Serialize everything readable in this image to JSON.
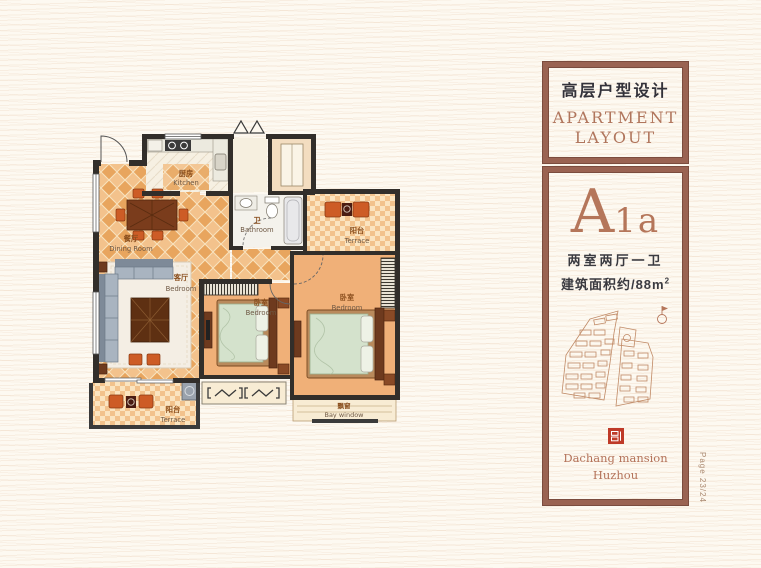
{
  "page": {
    "side_label": "Page 23/24"
  },
  "panel": {
    "title_cn": "高层户型设计",
    "title_en1": "APARTMENT",
    "title_en2": "LAYOUT",
    "unit_letter": "A",
    "unit_number": "1a",
    "spec_rooms": "两室两厅一卫",
    "spec_area": "建筑面积约/88m",
    "spec_area_sup": "2",
    "brand_name": "Dachang mansion",
    "brand_city": "Huzhou",
    "accent_color": "#b5765a",
    "frame_color": "#9a6352",
    "logo_color": "#bf3a28"
  },
  "floorplan": {
    "labels": {
      "kitchen_cn": "厨房",
      "kitchen_en": "Kitchen",
      "dining_cn": "餐厅",
      "dining_en": "Dining Room",
      "bath_cn": "卫",
      "bath_en": "Bathroom",
      "living_cn": "客厅",
      "living_en": "Bedroom",
      "terrace_tr_cn": "阳台",
      "terrace_tr_en": "Terrace",
      "bedroom_m_cn": "卧室",
      "bedroom_m_en": "Bedroom",
      "bedroom_r_cn": "卧室",
      "bedroom_r_en": "Bedroom",
      "terrace_bl_cn": "阳台",
      "terrace_bl_en": "Terrace",
      "bay_cn": "飘窗",
      "bay_en": "Bay window"
    }
  }
}
